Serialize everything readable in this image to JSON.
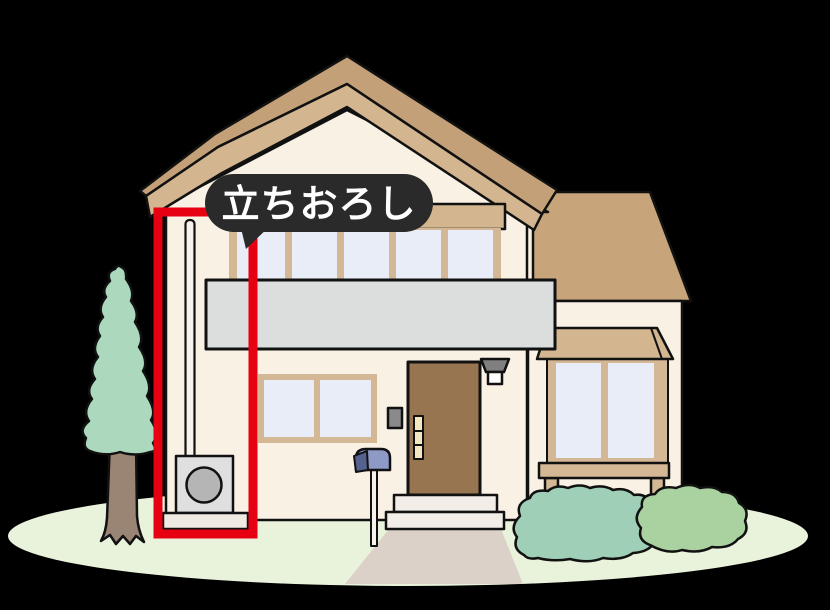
{
  "annotation": {
    "label": "立ちおろし",
    "bubble_color": "#2A2A2A",
    "label_color": "#FFFFFF",
    "highlight_color": "#E60012"
  },
  "palette": {
    "background": "#000000",
    "ground": "#E9F2DA",
    "roof": "#C3A078",
    "roof_fascia": "#D3B590",
    "wing_roof": "#C7A47A",
    "wall": "#FAF1E5",
    "window_glass": "#E9EDF8",
    "window_frame": "#D4B795",
    "balcony": "#DBDEDD",
    "door": "#967550",
    "door_glass": "#F3E6C3",
    "lamp_shade": "#808080",
    "lamp_bulb": "#FFFFFF",
    "doorbell": "#8A8A8A",
    "steps": "#F3EDE7",
    "walkway": "#DCD1C9",
    "tree_foliage": "#ACD9BD",
    "tree_trunk": "#9A8474",
    "bush_left": "#9FCFB7",
    "bush_right": "#A9D2A0",
    "ac_unit": "#DFDFDF",
    "ac_fan": "#B5B5B5",
    "base_slab": "#F1EAE3",
    "pipe": "#F7F3EC",
    "mailbox": "#8E99C6",
    "mailbox_lid": "#55618E",
    "outline": "#111111"
  }
}
